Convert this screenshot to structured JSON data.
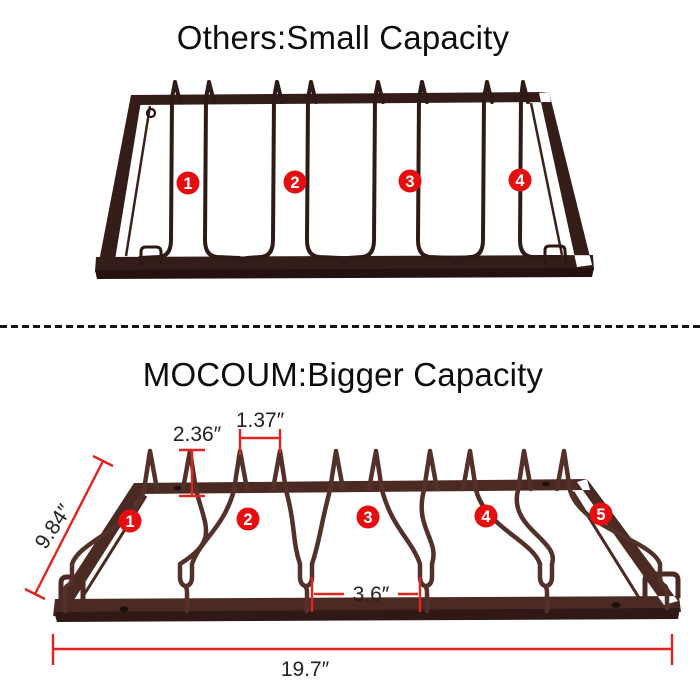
{
  "top_section": {
    "title": "Others:Small Capacity",
    "slot_numbers": [
      "1",
      "2",
      "3",
      "4"
    ]
  },
  "bottom_section": {
    "title": "MOCOUM:Bigger Capacity",
    "slot_numbers": [
      "1",
      "2",
      "3",
      "4",
      "5"
    ],
    "dimensions": {
      "prong_height": "2.36″",
      "prong_gap": "1.37″",
      "depth": "9.84″",
      "slot_width": "3.6″",
      "length": "19.7″"
    }
  },
  "colors": {
    "background": "#ffffff",
    "title_text": "#0d0d0d",
    "dimension_text": "#222222",
    "marker_red": "#e60d10",
    "dimension_red": "#e02420",
    "rack_dark_frame": "#341d18",
    "rack_dark_wire": "#2e1a16",
    "rack_brown_frame": "#4b2a23",
    "rack_brown_wire": "#53312a"
  }
}
